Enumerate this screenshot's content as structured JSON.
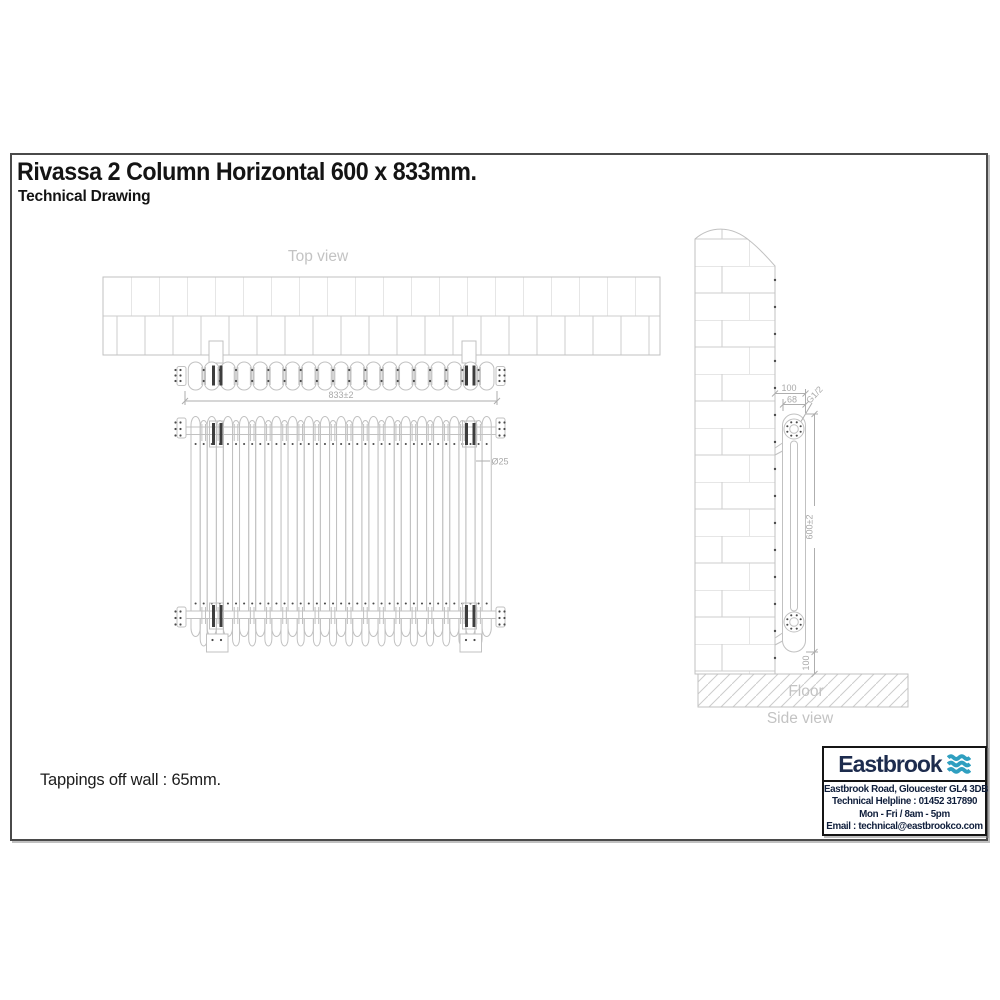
{
  "page": {
    "title": "Rivassa 2 Column Horizontal 600 x 833mm.",
    "subtitle": "Technical Drawing",
    "tappings_note": "Tappings off wall : 65mm."
  },
  "drawing": {
    "labels": {
      "top_view": "Top view",
      "side_view": "Side view",
      "floor": "Floor"
    },
    "dims": {
      "width": "833±2",
      "column_diameter": "Ø25",
      "wall_to_tapping": "100",
      "depth": "68",
      "thread": "G1/2",
      "height": "600±2",
      "floor_clearance": "100"
    },
    "colors": {
      "line": "#c1c1c1",
      "brick": "#cdcdcd",
      "dim": "#aeaeae",
      "dark_dot": "#4a4a4a",
      "bracket": "#3d3d3d",
      "label": "#c3c3c3"
    }
  },
  "footer_box": {
    "brand": "Eastbrook",
    "brand_color": "#1d2c4e",
    "wave_color": "#2f9fc0",
    "lines": [
      "Eastbrook Road, Gloucester GL4 3DB",
      "Technical Helpline : 01452 317890",
      "Mon - Fri / 8am - 5pm",
      "Email : technical@eastbrookco.com"
    ]
  }
}
